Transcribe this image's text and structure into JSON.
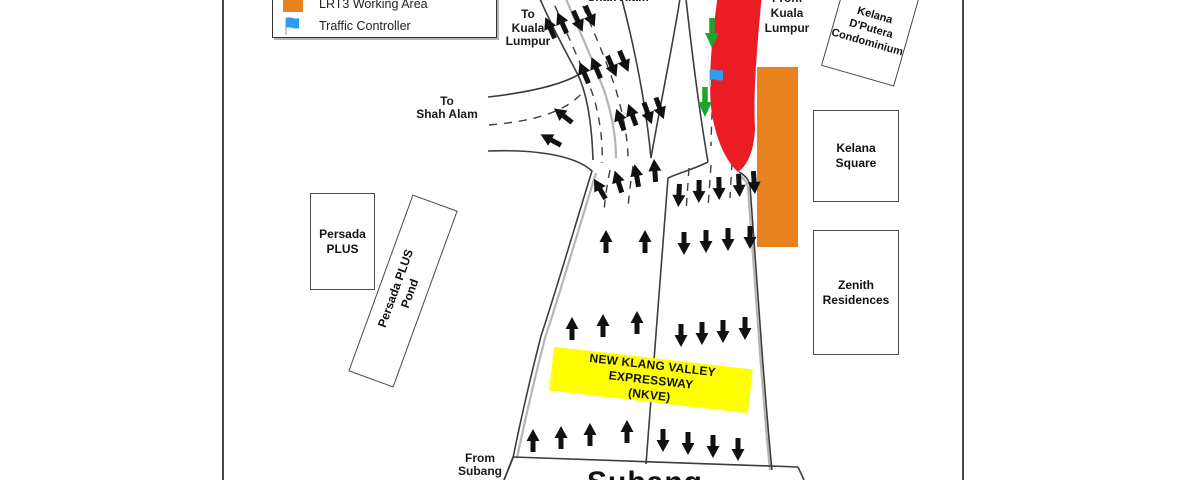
{
  "legend": {
    "items": [
      {
        "label": "LRT3 Working Area"
      },
      {
        "label": "Traffic Controller"
      }
    ]
  },
  "colors": {
    "working_area": "#E8821E",
    "road_closure": "#EC1C24",
    "expressway_sign_bg": "#FFFF00",
    "detour_arrow": "#1FA32B",
    "traffic_flag": "#2E9BF0",
    "traffic_arrow": "#111111"
  },
  "labels": {
    "to_kuala_lumpur": "To\nKuala\nLumpur",
    "from_shah_alam": "Shah Alam",
    "to_shah_alam": "To\nShah Alam",
    "from_kuala_lumpur": "From\nKuala\nLumpur",
    "from_subang": "From\nSubang",
    "subang_plate": "Subang",
    "expressway_sign": "NEW KLANG VALLEY EXPRESSWAY\n(NKVE)"
  },
  "buildings": [
    {
      "label": "Kelana\nD'Putera\nCondominium"
    },
    {
      "label": "Kelana\nSquare"
    },
    {
      "label": "Zenith\nResidences"
    },
    {
      "label": "Persada\nPLUS"
    },
    {
      "label": "Persada PLUS\nPond"
    }
  ]
}
